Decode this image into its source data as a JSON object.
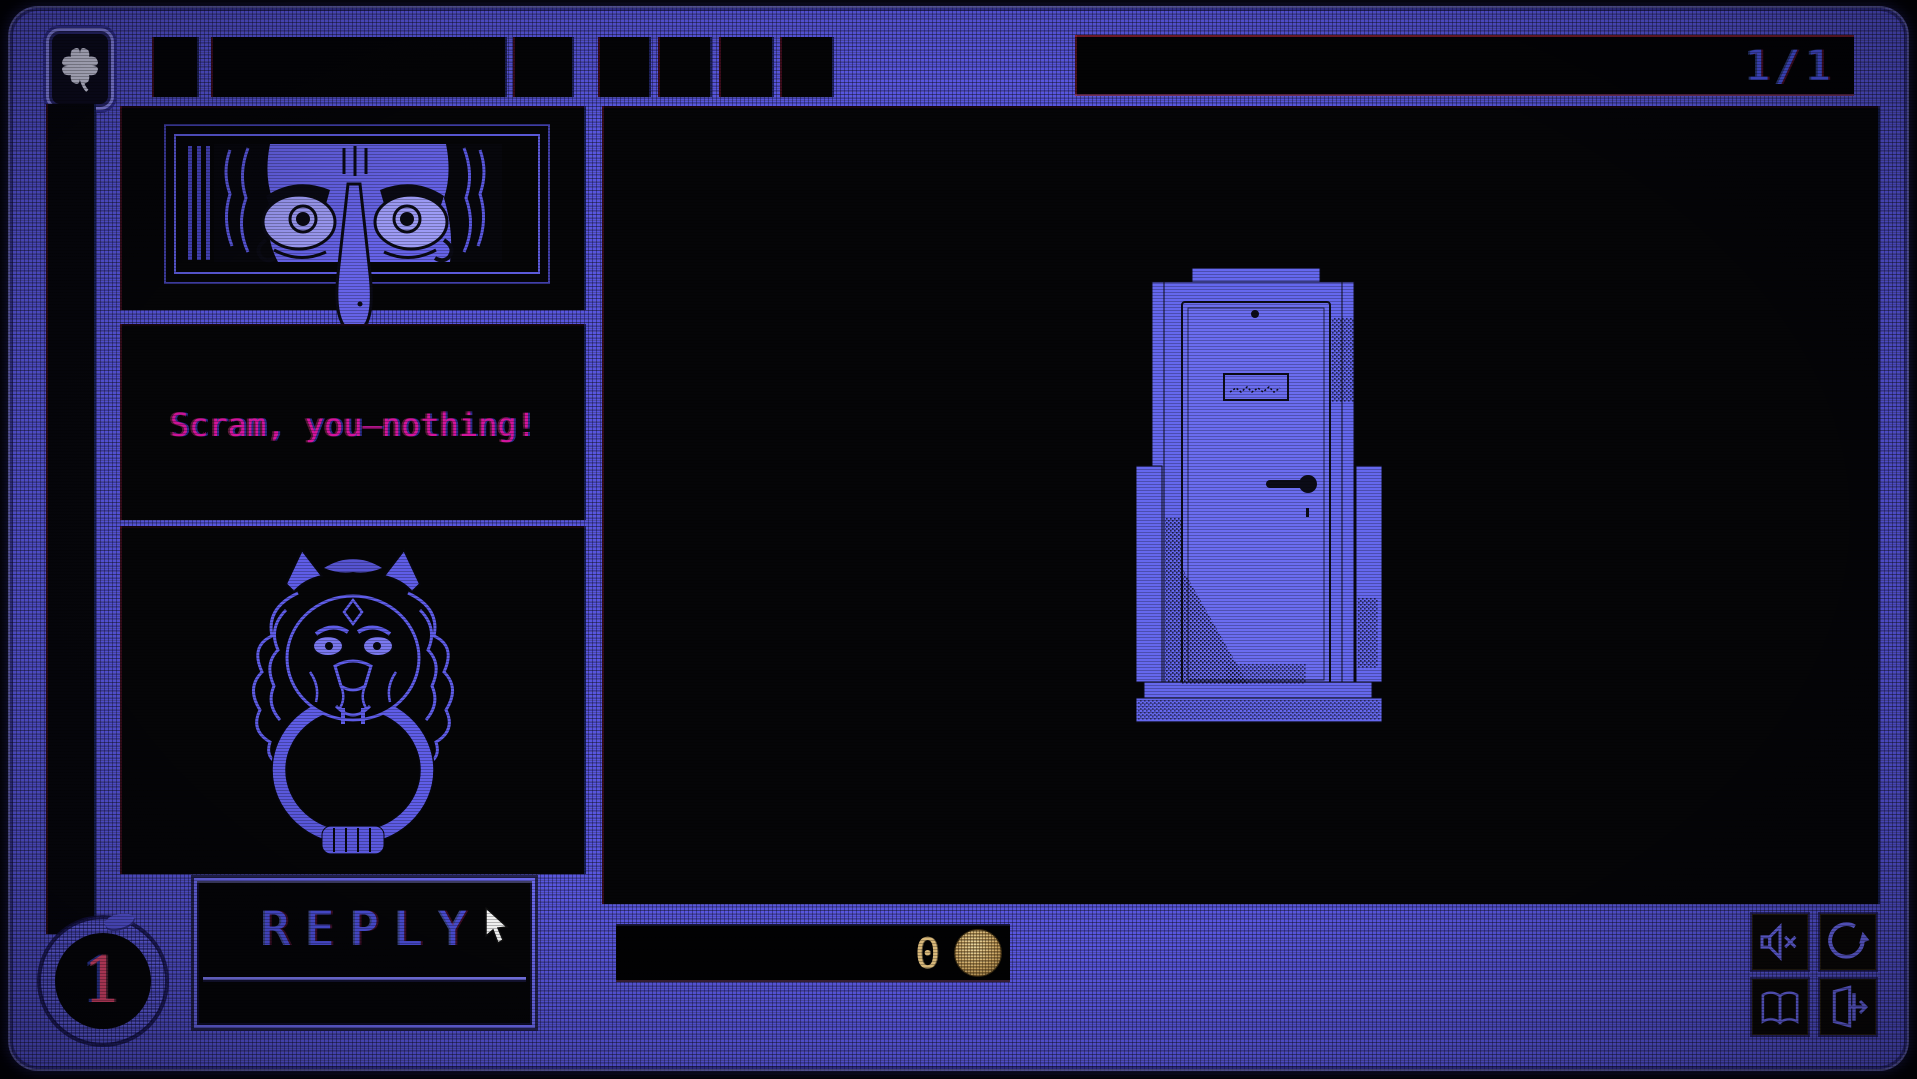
{
  "window": {
    "page_indicator": "1/1"
  },
  "topbar": {
    "clover_icon": "four-leaf-clover",
    "empty_item_slots": 7
  },
  "visitor": {
    "message": "Scram, you—nothing!",
    "portrait_icon": "eyes-through-door-slot"
  },
  "knocker": {
    "icon": "lion-door-knocker"
  },
  "scene": {
    "object": "apartment-door"
  },
  "reply_button": {
    "label": "REPLY"
  },
  "coin_counter": {
    "value": "0",
    "coin_icon": "gold-coin"
  },
  "day_counter": {
    "value": "1",
    "ring_icon": "ouroboros-snake-ring"
  },
  "controls": {
    "mute_icon": "speaker-muted",
    "restart_icon": "circular-restart-arrow",
    "journal_icon": "open-book",
    "exit_icon": "exit-door"
  },
  "colors": {
    "chassis_blue": "#5856df",
    "message_magenta": "#d4149c",
    "reply_blue": "#4d50dc",
    "page_blue": "#4a55e8",
    "gold": "#d8b87a",
    "day_pink": "#e5486e"
  }
}
